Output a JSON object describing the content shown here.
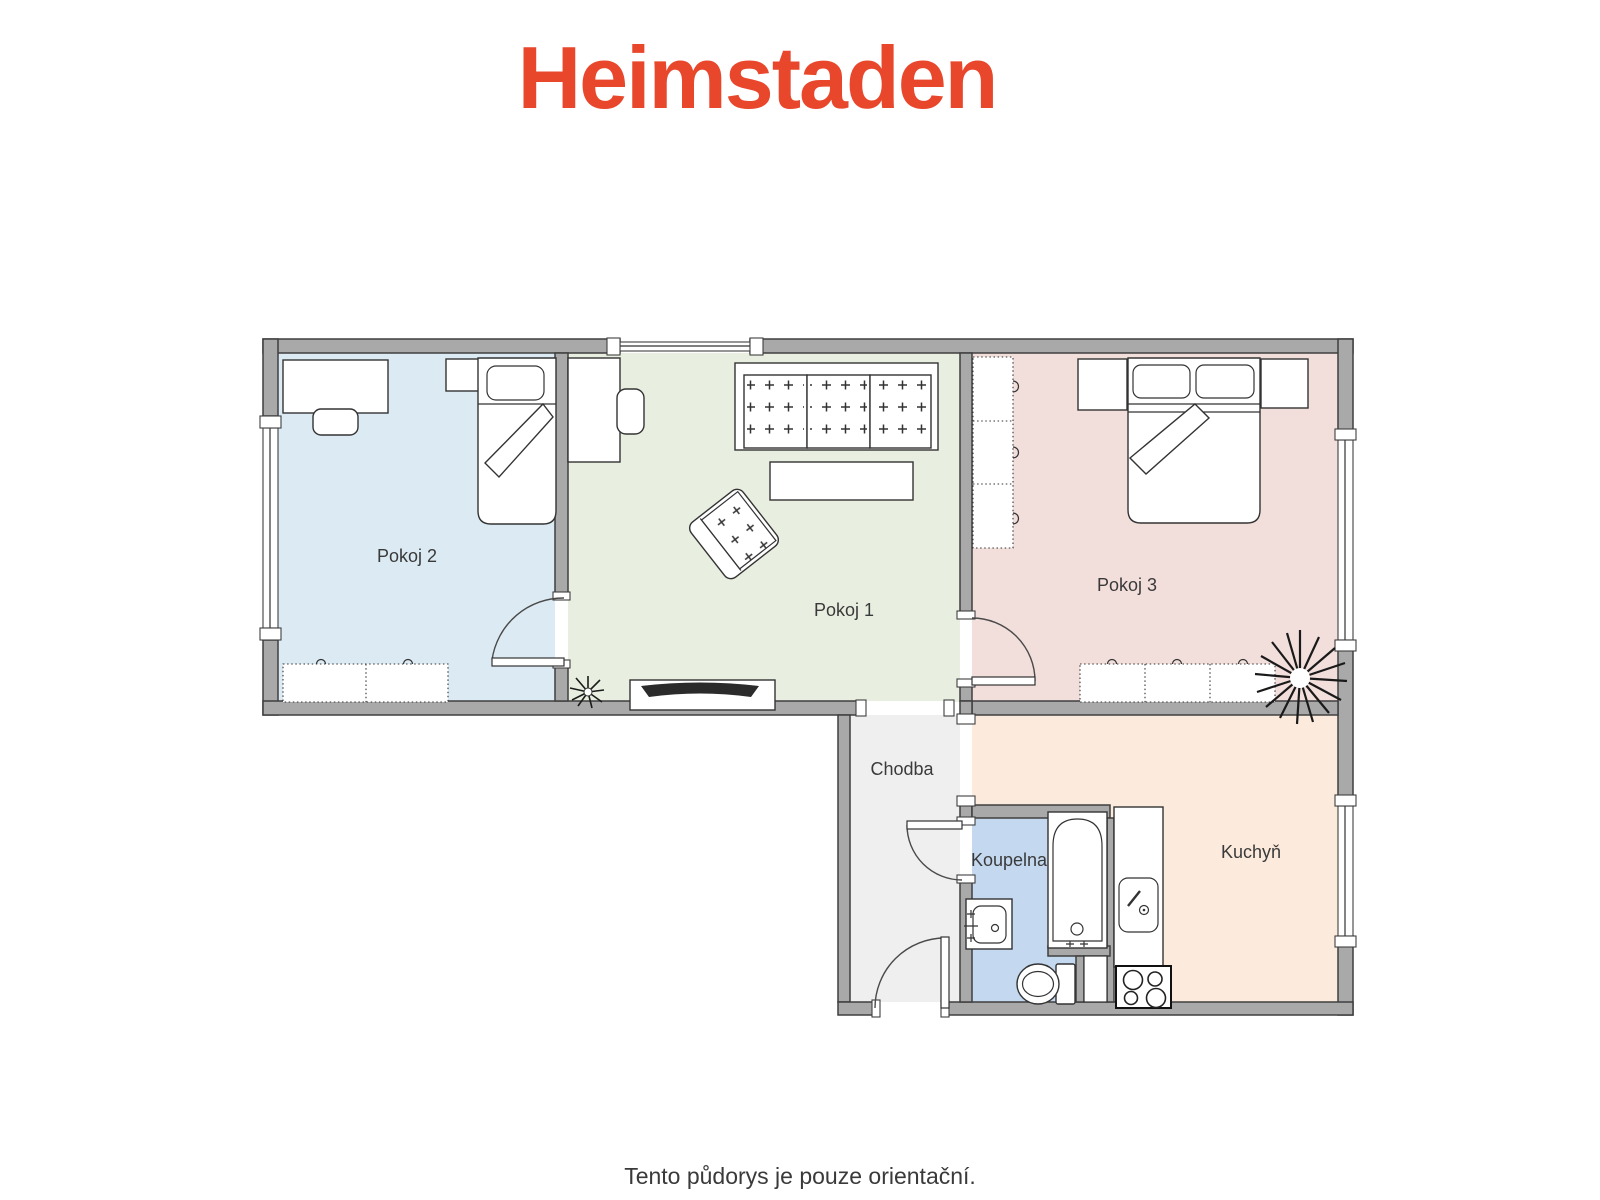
{
  "header": {
    "logo_text": "Heimstaden",
    "logo_color": "#e8472c"
  },
  "floorplan": {
    "wall_color": "#a9a9a9",
    "outline_color": "#3f3f3f",
    "rooms": [
      {
        "id": "pokoj1",
        "label": "Pokoj 1",
        "floor_color": "#e9efe0"
      },
      {
        "id": "pokoj2",
        "label": "Pokoj 2",
        "floor_color": "#dcebf3"
      },
      {
        "id": "pokoj3",
        "label": "Pokoj 3",
        "floor_color": "#f2dfdb"
      },
      {
        "id": "chodba",
        "label": "Chodba",
        "floor_color": "#efefef"
      },
      {
        "id": "koupelna",
        "label": "Koupelna",
        "floor_color": "#c4d8ef"
      },
      {
        "id": "kuchyn",
        "label": "Kuchyň",
        "floor_color": "#fcebdc"
      }
    ],
    "furniture": [
      "desk",
      "chair",
      "single-bed",
      "double-bed",
      "pillow",
      "dresser",
      "wardrobe",
      "bedside-table",
      "sofa",
      "armchair",
      "coffee-table",
      "tv-cabinet",
      "plant",
      "bathtub",
      "washbasin",
      "toilet",
      "kitchen-counter",
      "kitchen-sink",
      "stove"
    ]
  },
  "footer": {
    "disclaimer": "Tento půdorys je pouze orientační."
  }
}
